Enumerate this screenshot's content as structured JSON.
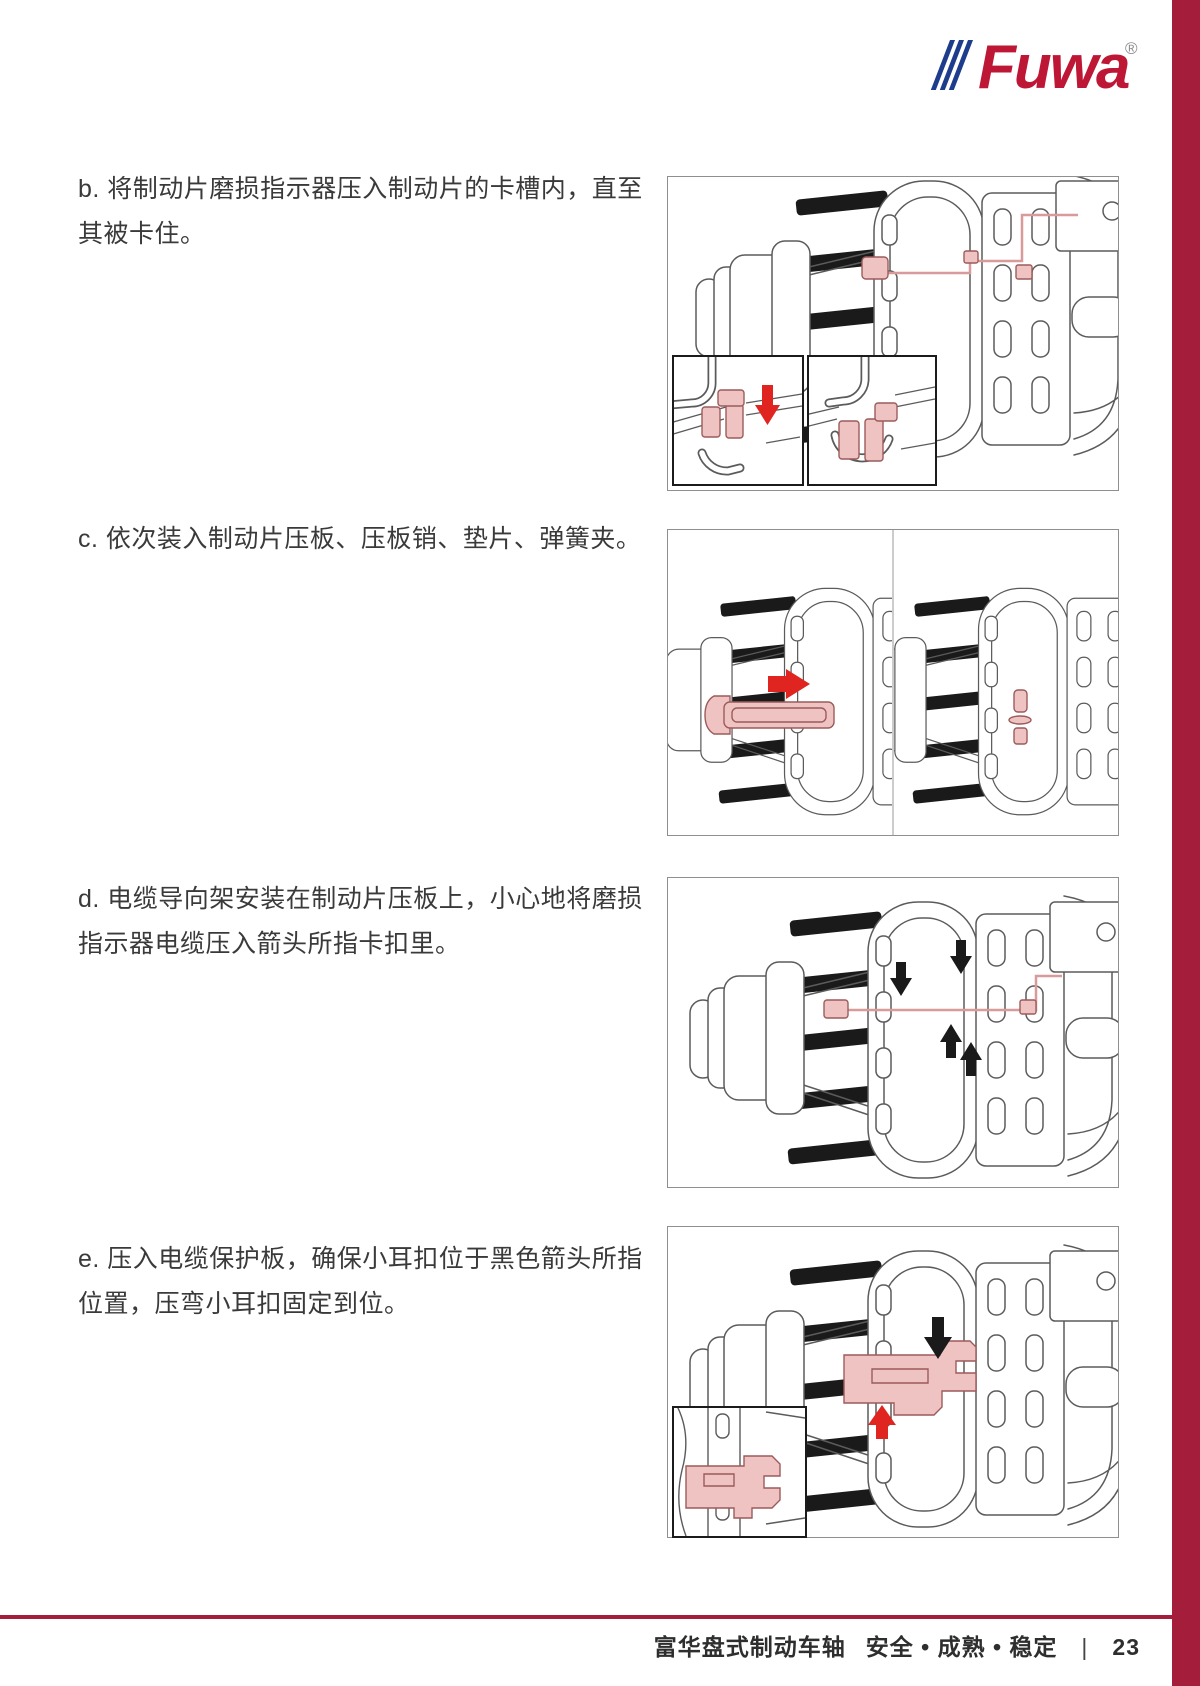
{
  "brand": {
    "logo_text": "Fuwa",
    "registered_mark": "®",
    "logo_red": "#BE1635",
    "logo_blue": "#1E3C8C",
    "sidebar_color": "#A41E3C"
  },
  "steps": [
    {
      "id": "b",
      "text": "b. 将制动片磨损指示器压入制动片的卡槽内，直至其被卡住。"
    },
    {
      "id": "c",
      "text": "c. 依次装入制动片压板、压板销、垫片、弹簧夹。"
    },
    {
      "id": "d",
      "text": "d. 电缆导向架安装在制动片压板上，小心地将磨损指示器电缆压入箭头所指卡扣里。"
    },
    {
      "id": "e",
      "text": "e. 压入电缆保护板，确保小耳扣位于黑色箭头所指位置，压弯小耳扣固定到位。"
    }
  ],
  "panels": {
    "b": {
      "arrow_icons": [
        "red-down-arrow-icon"
      ],
      "inset_count": 2
    },
    "c": {
      "arrow_icons": [
        "red-right-arrow-icon"
      ],
      "inset_count": 0
    },
    "d": {
      "arrow_icons": [
        "black-down-arrow-icon",
        "black-down-arrow-icon",
        "black-up-arrow-icon",
        "black-up-arrow-icon"
      ],
      "inset_count": 0
    },
    "e": {
      "arrow_icons": [
        "black-down-arrow-icon",
        "red-up-arrow-icon"
      ],
      "inset_count": 1
    }
  },
  "footer": {
    "product": "富华盘式制动车轴",
    "tagline": "安全 • 成熟 • 稳定",
    "separator": "|",
    "page_number": "23",
    "rule_color": "#A41E3C"
  },
  "colors": {
    "drawing_line": "#5b5b5b",
    "highlight_fill": "#f0c3c3",
    "highlight_stroke": "#9c5b5b",
    "red_arrow": "#e0241f",
    "black_arrow": "#1a1a1a",
    "panel_border": "#8f8f8f",
    "inset_border": "#1b1b1b",
    "text": "#3a3a3a"
  }
}
